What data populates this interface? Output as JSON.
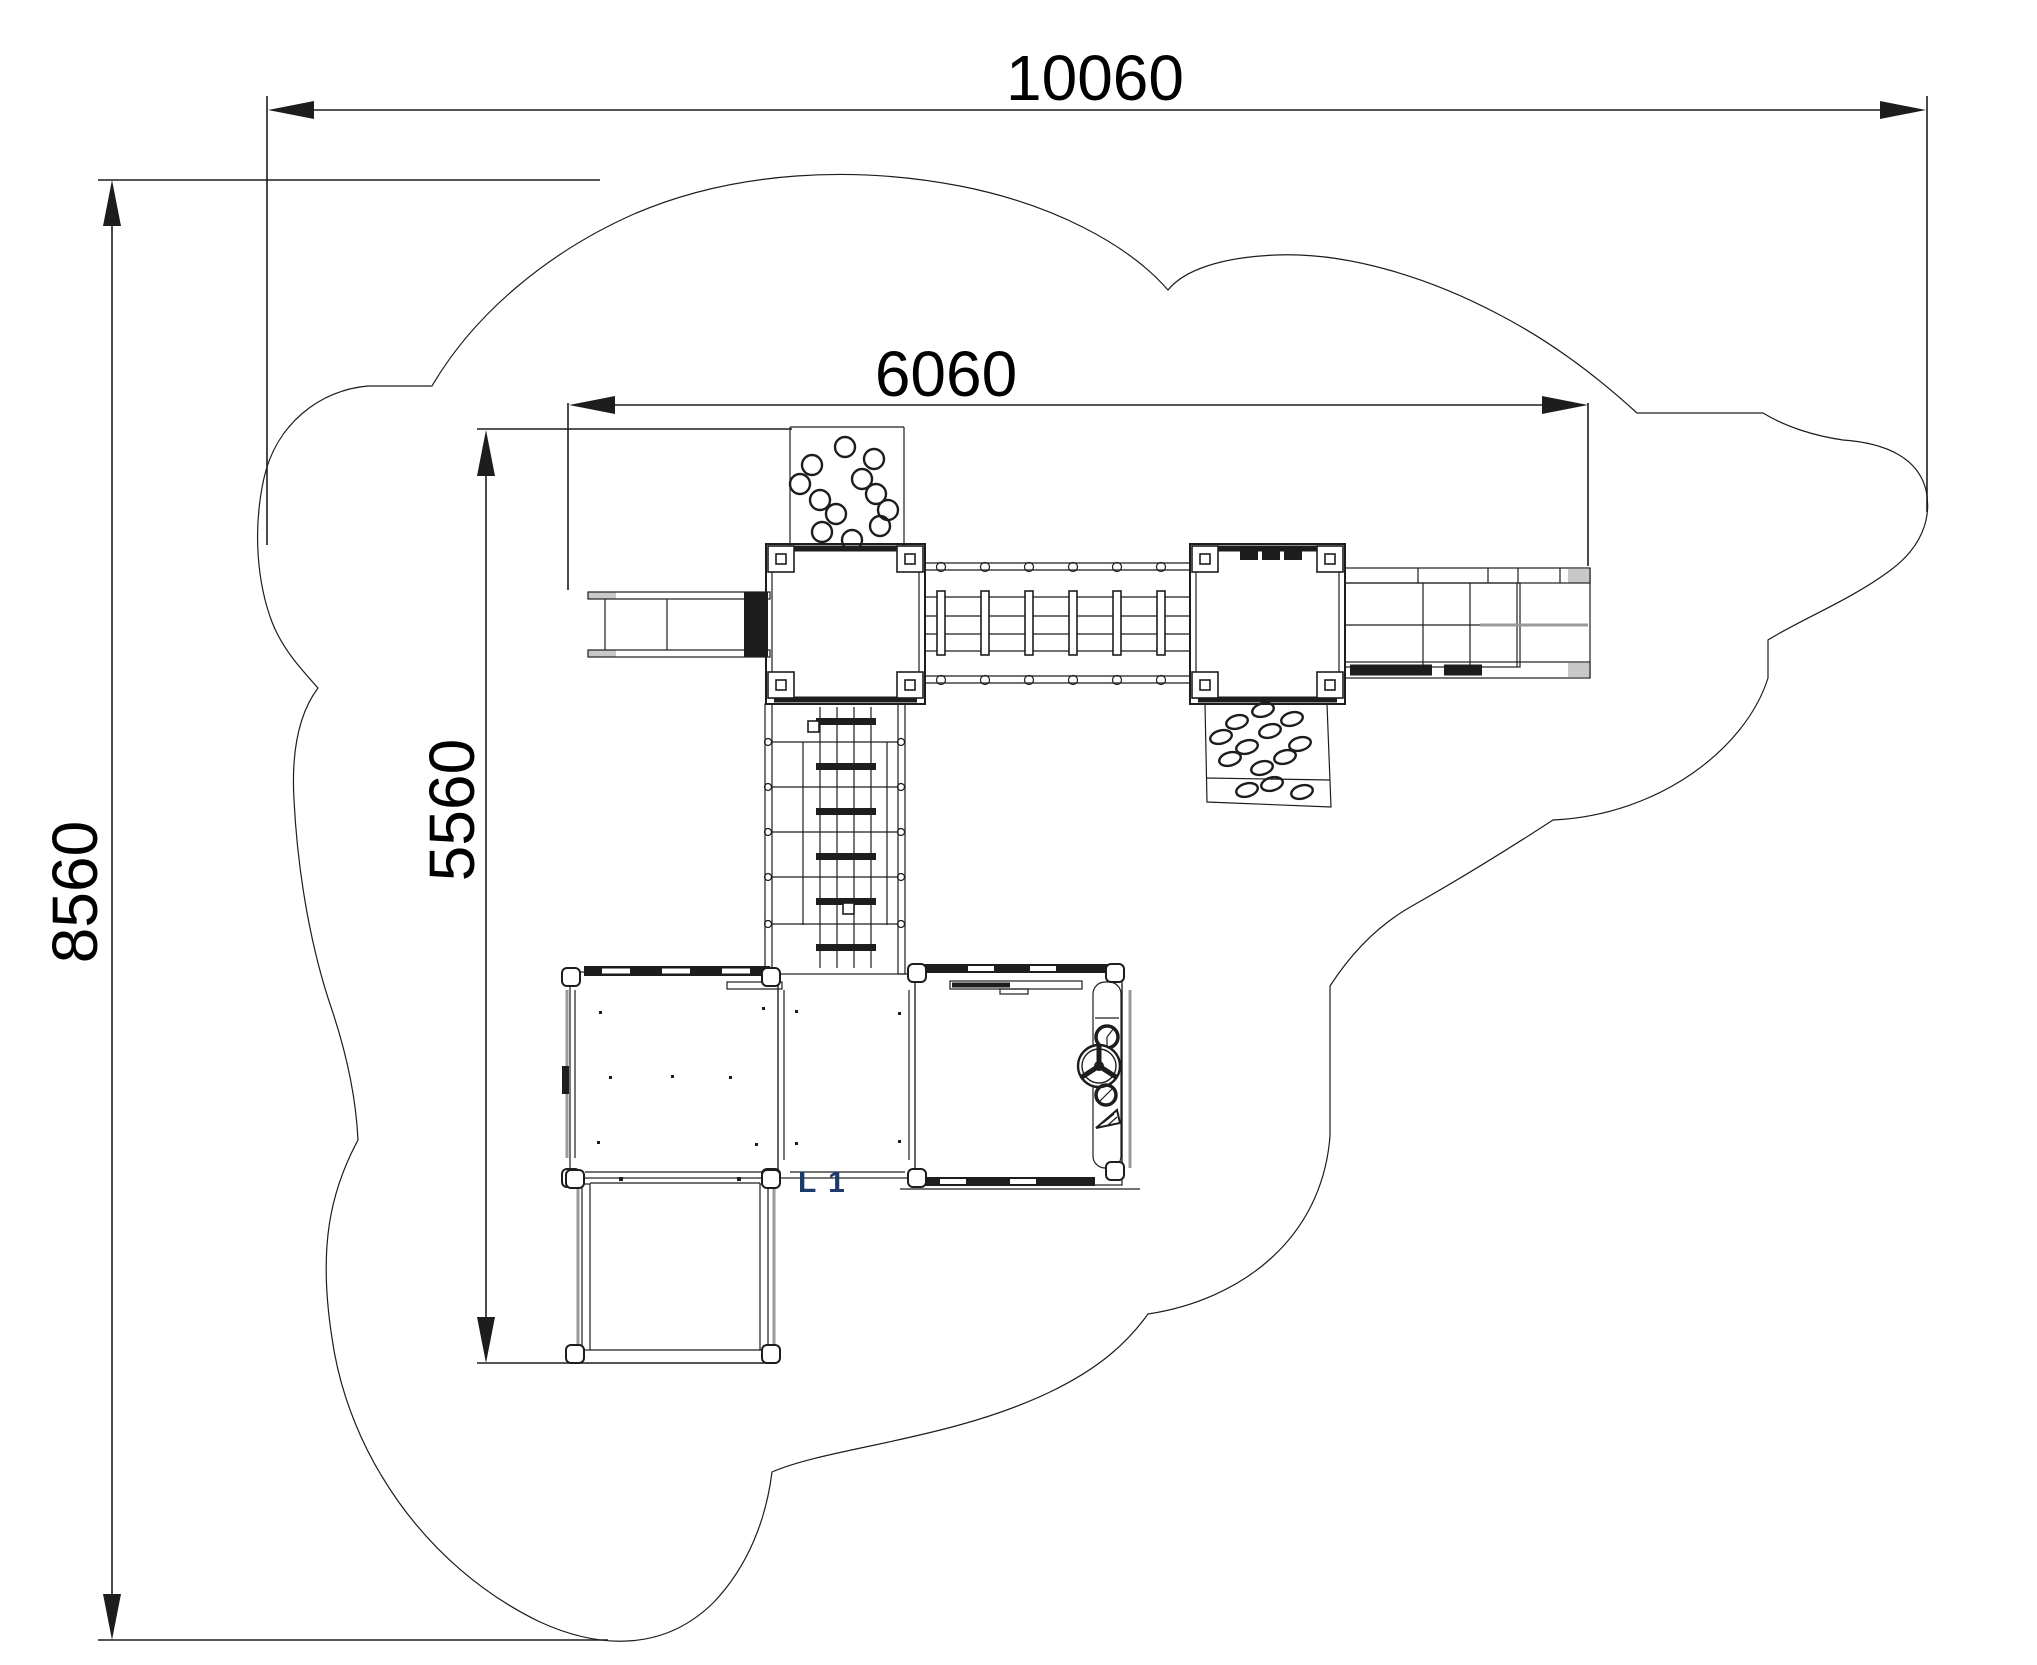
{
  "drawing": {
    "type": "playground-equipment-plan-top-view",
    "dimensions": {
      "overall_width_mm": "10060",
      "inner_width_mm": "6060",
      "overall_depth_mm": "8560",
      "inner_depth_mm": "5560"
    },
    "labels": {
      "slide_id": "L 1"
    },
    "colors": {
      "line": "#1d1d1d",
      "label": "#000000",
      "slide_id": "#1c3a6b",
      "shadow": "#9a9a9a",
      "cap": "#c8c8c8"
    }
  }
}
